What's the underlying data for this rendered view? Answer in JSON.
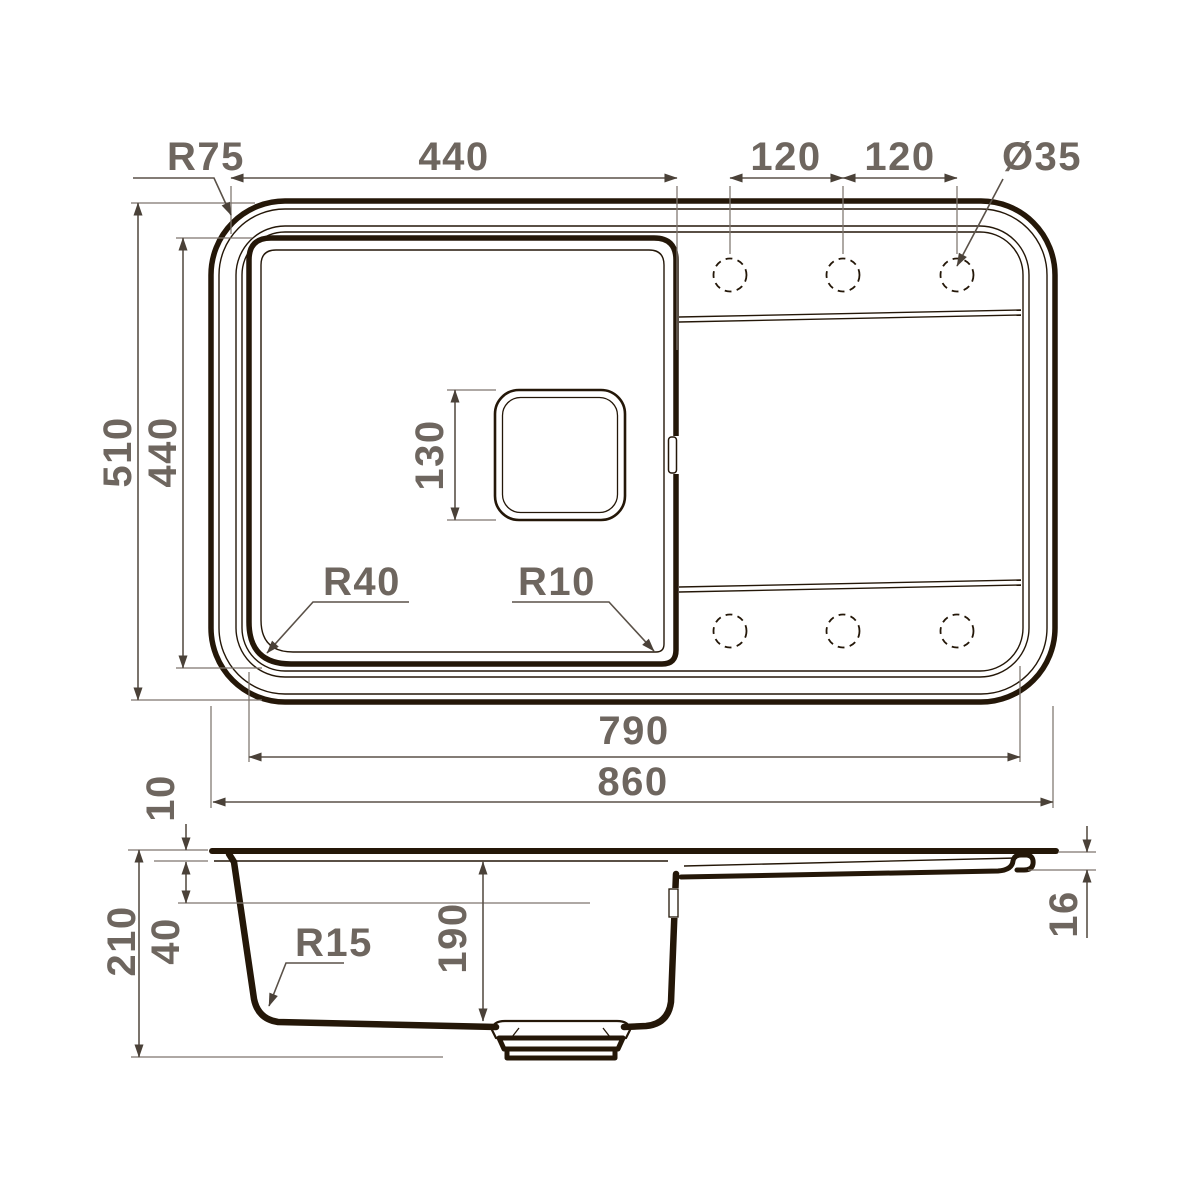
{
  "drawing": {
    "type": "technical-dimension-drawing",
    "views": [
      "top-view",
      "side-section-view"
    ],
    "units_implied": "mm",
    "colors": {
      "ink": "#241708",
      "dimension_line": "#5a5148",
      "dimension_text": "#6e665f",
      "background": "#ffffff"
    },
    "top_view": {
      "labels": {
        "corner_radius": "R75",
        "bowl_width": "440",
        "hole_pitch_left": "120",
        "hole_pitch_right": "120",
        "hole_diameter": "Ø35",
        "overall_depth": "510",
        "bowl_depth": "440",
        "drain_size": "130",
        "bowl_corner_radius": "R40",
        "drain_area_corner_radius": "R10",
        "inner_length": "790",
        "overall_length": "860"
      },
      "faucet_hole_count": 6
    },
    "side_view": {
      "labels": {
        "rim_height": "10",
        "overall_height": "210",
        "upper_wall_depth": "40",
        "bottom_corner_radius": "R15",
        "bowl_inner_depth": "190",
        "edge_thickness": "16"
      }
    }
  }
}
